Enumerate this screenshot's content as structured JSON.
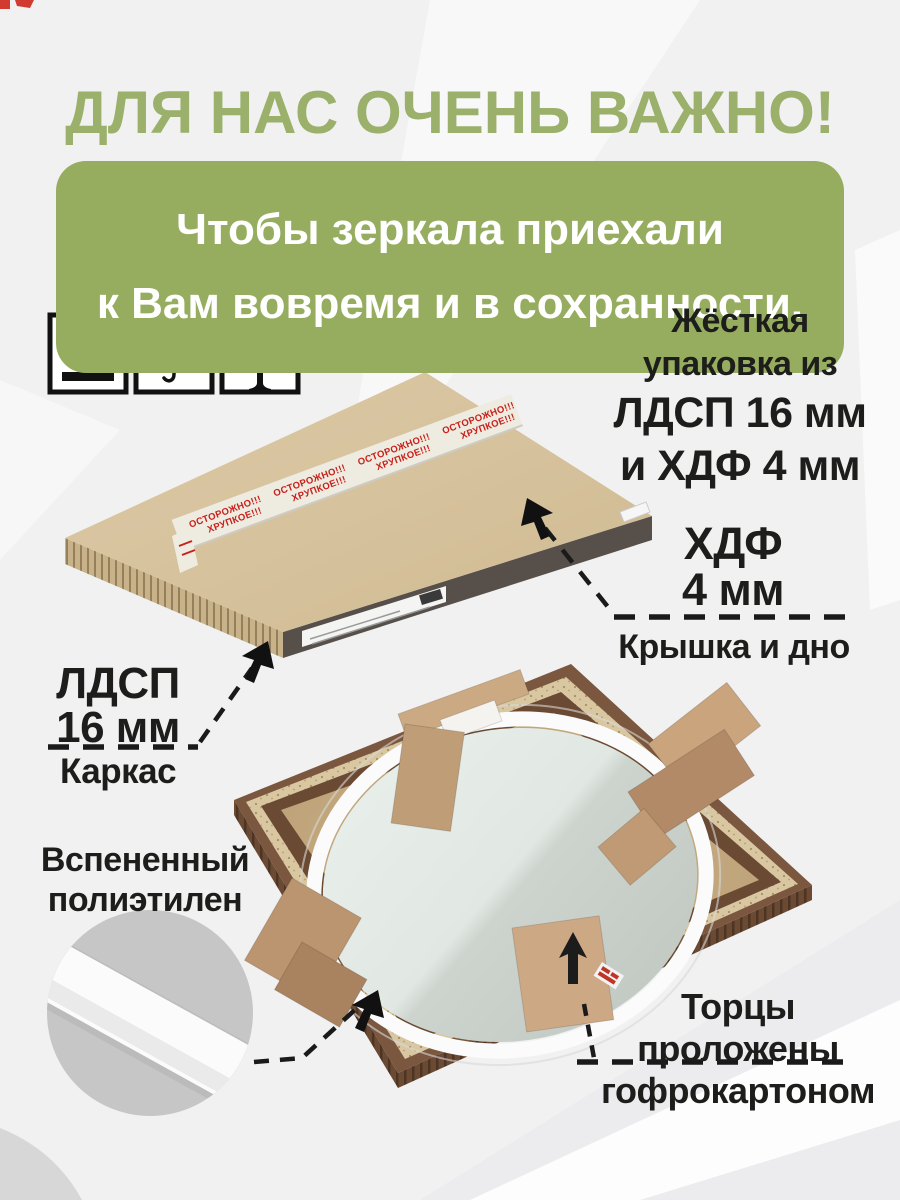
{
  "header": {
    "title": "ДЛЯ НАС ОЧЕНЬ ВАЖНО!",
    "banner_line1": "Чтобы зеркала приехали",
    "banner_line2": "к Вам вовремя и в сохранности."
  },
  "handling_icons": [
    {
      "name": "this-side-up"
    },
    {
      "name": "keep-dry"
    },
    {
      "name": "fragile"
    }
  ],
  "callouts": {
    "rigid": {
      "line1": "Жёсткая",
      "line2": "упаковка из",
      "line3": "ЛДСП 16 мм",
      "line4": "и ХДФ 4 мм"
    },
    "hdf": {
      "material": "ХДФ",
      "thickness": "4 мм",
      "caption": "Крышка и дно"
    },
    "ldsp": {
      "material": "ЛДСП",
      "thickness": "16 мм",
      "caption": "Каркас"
    },
    "foam": {
      "line1": "Вспененный",
      "line2": "полиэтилен"
    },
    "edges": {
      "line1": "Торцы",
      "line2": "проложены",
      "line3": "гофрокартоном"
    }
  },
  "tape": {
    "line1": "ОСТОРОЖНО!!!",
    "line2": "ХРУПКОЕ!!!"
  },
  "colors": {
    "accent_green": "#9bb06a",
    "banner_green": "#96ad5f",
    "warning_red": "#c8201a",
    "kraft": "#d8c5a0",
    "wood_dark": "#6b4a33"
  }
}
